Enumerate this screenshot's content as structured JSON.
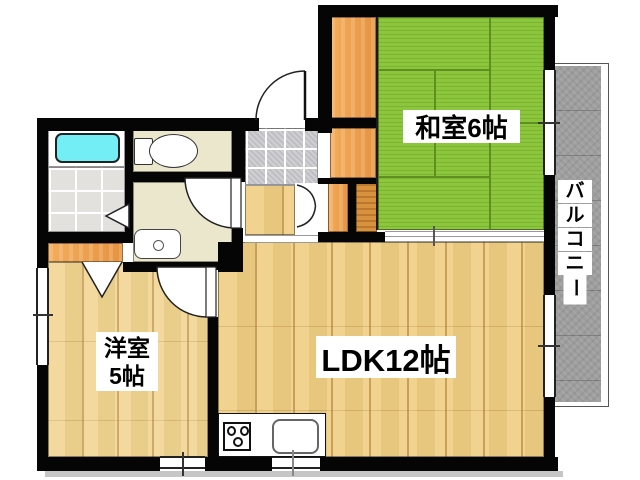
{
  "floorplan": {
    "rooms": {
      "washitsu": {
        "label": "和室6帖",
        "floor_color": "#8CC63C"
      },
      "ldk": {
        "label": "LDK12帖",
        "floor_color": "#EFCD82"
      },
      "youshitsu": {
        "label_line1": "洋室",
        "label_line2": "5帖",
        "floor_color": "#F1D48F"
      },
      "balcony": {
        "label": "バルコニー",
        "floor_color": "#9E9E9E"
      }
    },
    "colors": {
      "wall": "#050505",
      "tatami_green": "#8CC63C",
      "wood_floor": "#EFCD82",
      "closet_orange": "#EDA250",
      "bathtub_cyan": "#73EEF4",
      "service_room_beige": "#EAE7CC",
      "balcony_gray": "#9E9E9E",
      "bath_tile": "#E2E1DD",
      "genkan_tile": "#C9C9CE"
    },
    "fixtures": [
      "bathtub",
      "toilet",
      "washbasin",
      "stove",
      "kitchen-sink"
    ]
  }
}
